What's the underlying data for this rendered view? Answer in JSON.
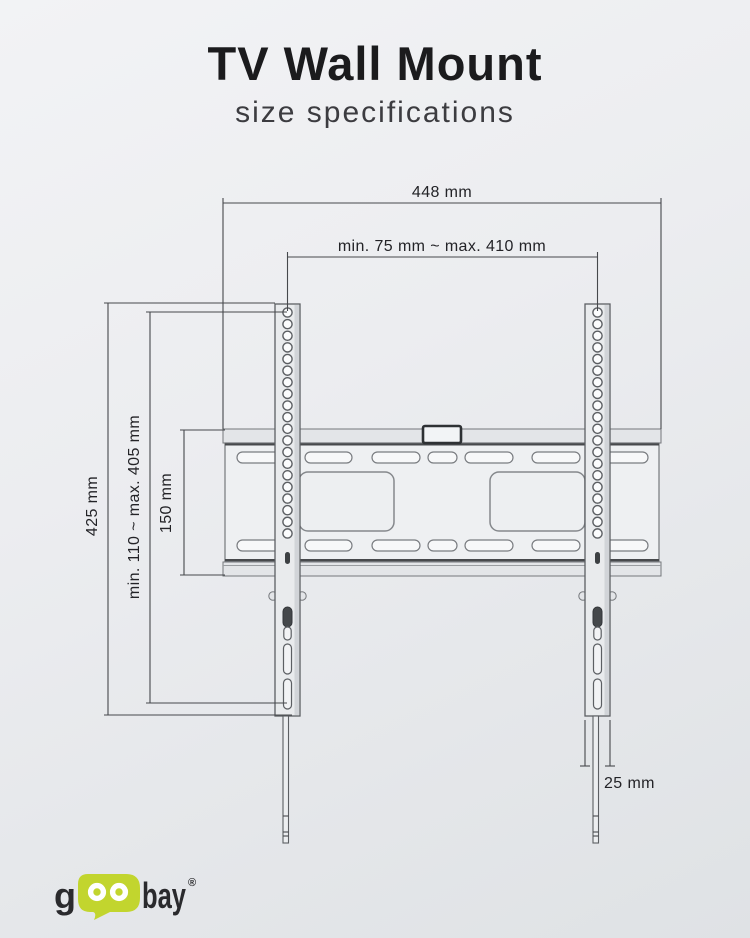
{
  "header": {
    "title": "TV Wall Mount",
    "subtitle": "size specifications"
  },
  "dimensions": {
    "plate_width": "448 mm",
    "hole_pattern_width": "min. 75 mm ~ max. 410 mm",
    "bracket_height": "425 mm",
    "hole_pattern_height": "min. 110 ~ max. 405 mm",
    "plate_height": "150 mm",
    "bracket_width": "25 mm"
  },
  "drawing": {
    "rail_hole_count": 20,
    "rail_hole_start_y": 312.5,
    "rail_hole_step": 11.63,
    "line_color": "#46484c"
  },
  "brand": {
    "prefix": "g",
    "suffix": "bay",
    "registered": "®",
    "bubble_color": "#c2d52e",
    "text_color": "#2a2a2d"
  }
}
